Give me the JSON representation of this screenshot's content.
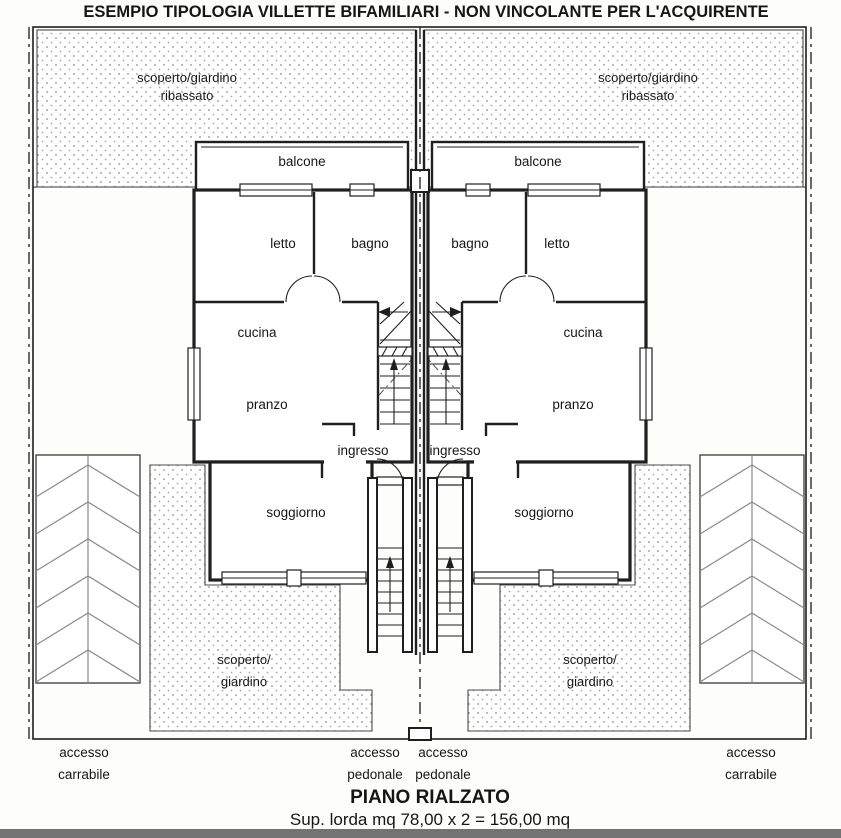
{
  "page": {
    "title": "ESEMPIO TIPOLOGIA VILLETTE BIFAMILIARI - NON VINCOLANTE PER L'ACQUIRENTE",
    "floor_label": "PIANO RIALZATO",
    "area_label": "Sup. lorda mq 78,00 x 2 = 156,00 mq"
  },
  "rooms": {
    "balcony": "balcone",
    "bedroom": "letto",
    "bathroom": "bagno",
    "kitchen": "cucina",
    "dining": "pranzo",
    "entry": "ingresso",
    "living": "soggiorno"
  },
  "site": {
    "sunken_garden_line1": "scoperto/giardino",
    "sunken_garden_line2": "ribassato",
    "garden_line1": "scoperto/",
    "garden_line2": "giardino",
    "drive_access_line1": "accesso",
    "drive_access_line2": "carrabile",
    "pedestrian_access_line1": "accesso",
    "pedestrian_access_line2": "pedonale"
  },
  "colors": {
    "ink": "#1f1f1f",
    "paper": "#fdfdfb",
    "dot": "#8f8f8f",
    "scan_bar": "#5a5a5a"
  }
}
